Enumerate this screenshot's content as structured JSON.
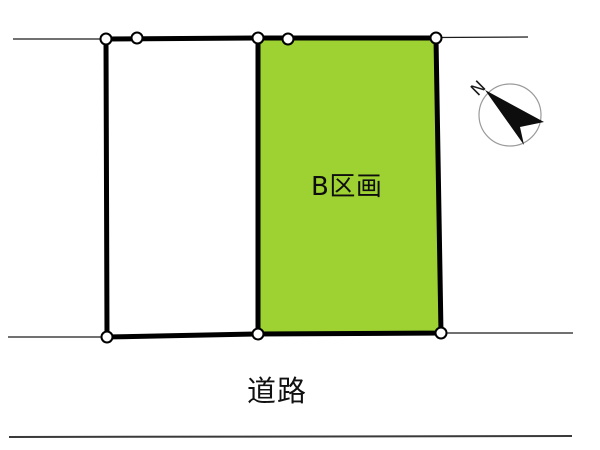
{
  "diagram_title": "land-plot-layout",
  "plots": {
    "plot_b": {
      "label": "B区画",
      "fill": "#9ed233"
    },
    "plot_left": {
      "label": "",
      "fill": "#ffffff"
    }
  },
  "road": {
    "label": "道路"
  },
  "compass": {
    "label": "N"
  },
  "colors": {
    "boundary": "#000000",
    "thin_line": "#1c1c1c",
    "road_edge": "#3a3a3a",
    "compass_ring": "#9a9a9a",
    "compass_arrow": "#0d0d0d",
    "marker_fill": "#ffffff",
    "marker_stroke": "#000000"
  }
}
